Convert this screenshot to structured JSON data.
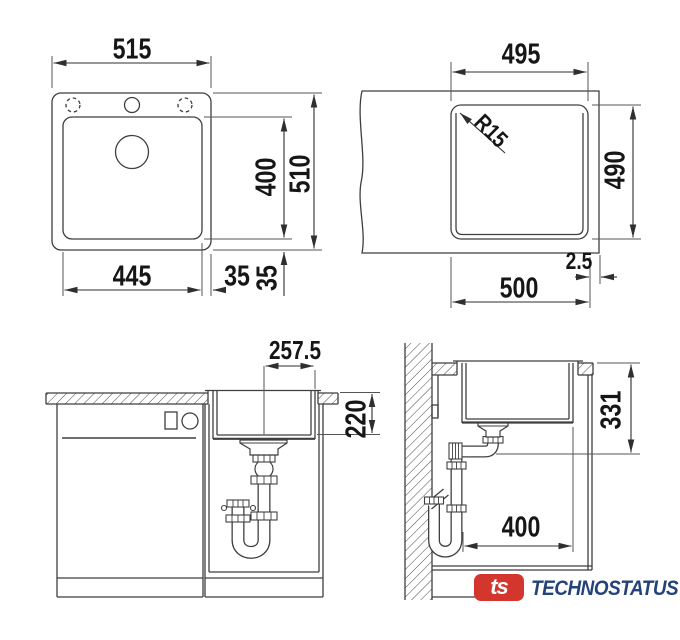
{
  "drawings": {
    "top_view": {
      "overall_width": "515",
      "overall_height": "510",
      "bowl_height": "400",
      "bowl_width": "445",
      "edge_gap_horizontal": "35",
      "edge_gap_vertical": "35"
    },
    "cutout_view": {
      "cutout_width": "495",
      "corner_radius": "R15",
      "cutout_height": "490",
      "edge_offset": "2.5",
      "outer_width": "500"
    },
    "front_view": {
      "drain_center_offset": "257.5",
      "bowl_depth": "220"
    },
    "side_view": {
      "drain_height": "331",
      "bowl_length": "400"
    }
  },
  "logo": {
    "mark": "ts",
    "brand": "TECHNOSTATUS"
  },
  "colors": {
    "line": "#3f3f3f",
    "dimension": "#2f2f2f",
    "label": "#161616",
    "hatch": "#4a4a4a",
    "logo_red": "#d2362c",
    "logo_blue": "#24437a",
    "background": "#ffffff"
  }
}
